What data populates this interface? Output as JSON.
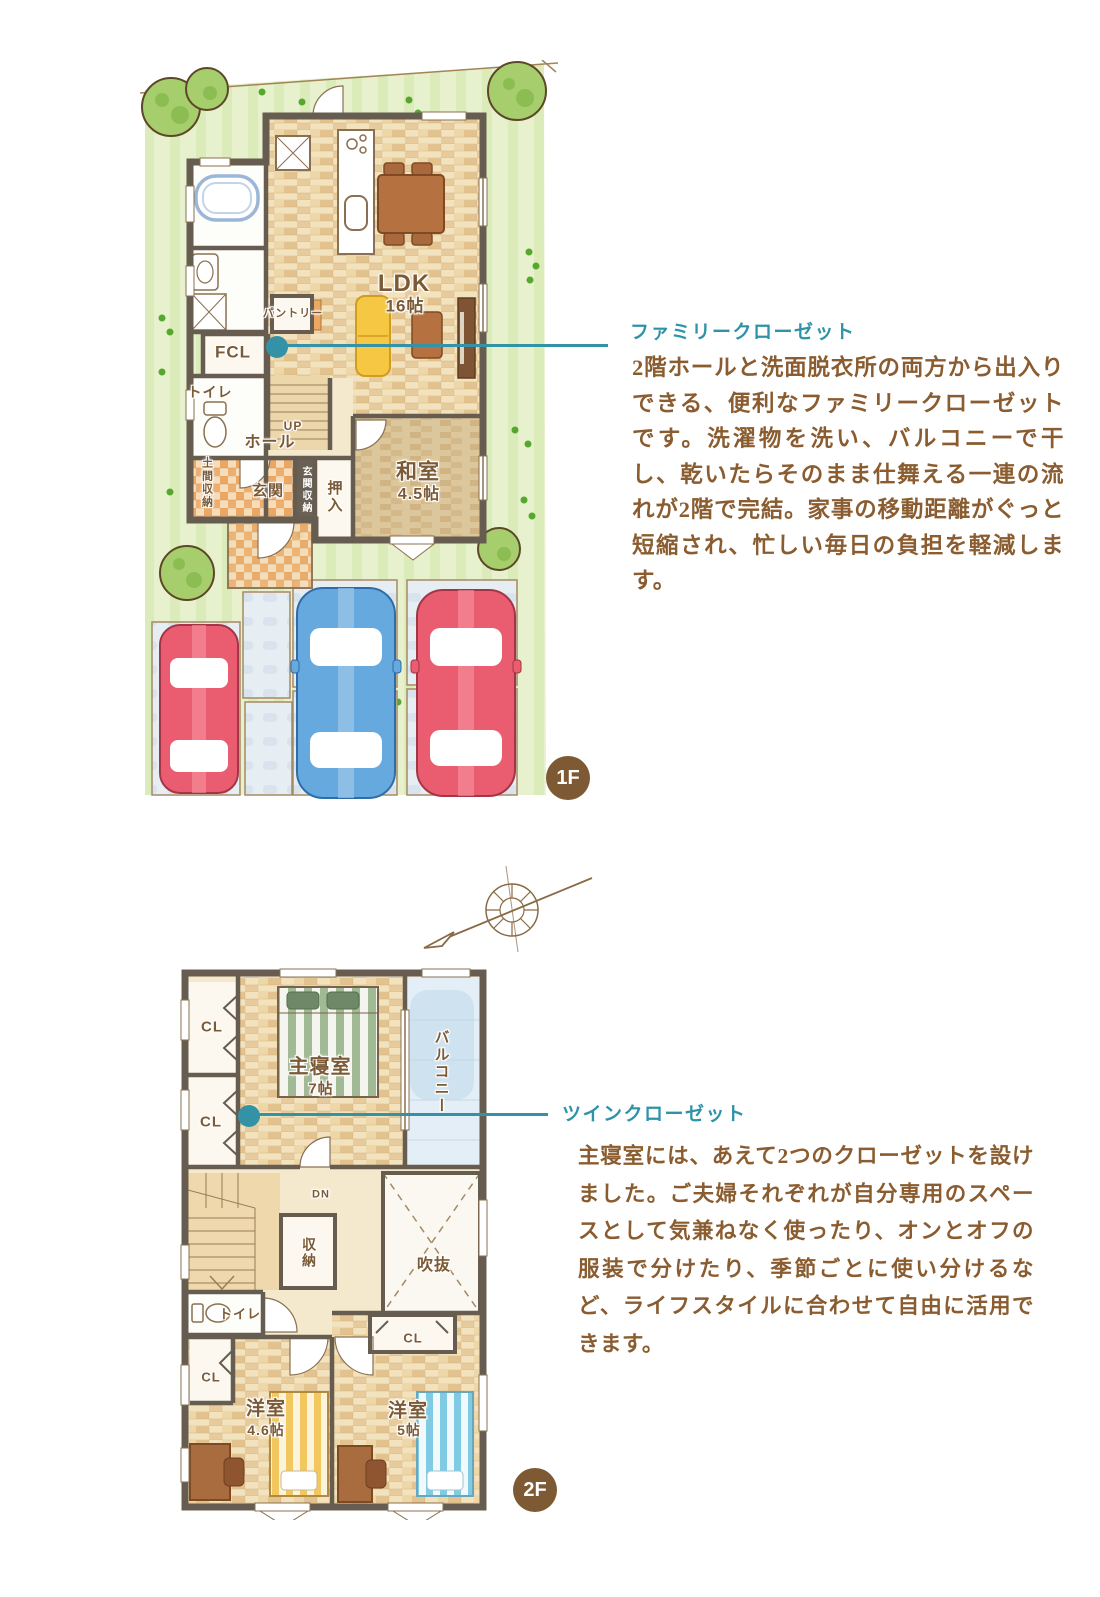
{
  "colors": {
    "accent_teal": "#3492a6",
    "title_teal": "#2e93a8",
    "body_brown": "#8a5c2f",
    "badge_brown": "#7d5a33",
    "wall": "#665c50",
    "lawn_green": "#e7f1cd",
    "wood_floor": "#f2e2bd",
    "car_red": "#ea5d70",
    "car_blue": "#66a9de"
  },
  "floor1": {
    "badge": "1F",
    "labels": {
      "ldk": "LDK",
      "ldk_size": "16帖",
      "pantry": "パントリー",
      "fcl": "FCL",
      "toilet": "トイレ",
      "up": "UP",
      "hall": "ホール",
      "genkan": "玄関",
      "genkan_storage": "玄関収納",
      "doma_storage": "土間収納",
      "oshiire": "押入",
      "washitsu": "和室",
      "washitsu_size": "4.5帖"
    }
  },
  "floor2": {
    "badge": "2F",
    "labels": {
      "cl_a": "CL",
      "cl_b": "CL",
      "cl_c": "CL",
      "cl_d": "CL",
      "master": "主寝室",
      "master_size": "7帖",
      "balcony": "バルコニー",
      "dn": "DN",
      "storage": "収納",
      "void": "吹抜",
      "toilet": "トイレ",
      "west_room1": "洋室",
      "west_room1_size": "4.6帖",
      "west_room2": "洋室",
      "west_room2_size": "5帖"
    }
  },
  "annotations": [
    {
      "title": "ファミリークローゼット",
      "body": "2階ホールと洗面脱衣所の両方から出入りできる、便利なファミリークローゼットです。洗濯物を洗い、バルコニーで干し、乾いたらそのまま仕舞える一連の流れが2階で完結。家事の移動距離がぐっと短縮され、忙しい毎日の負担を軽減します。"
    },
    {
      "title": "ツインクローゼット",
      "body": "主寝室には、あえて2つのクローゼットを設けました。ご夫婦それぞれが自分専用のスペースとして気兼ねなく使ったり、オンとオフの服装で分けたり、季節ごとに使い分けるなど、ライフスタイルに合わせて自由に活用できます。"
    }
  ]
}
